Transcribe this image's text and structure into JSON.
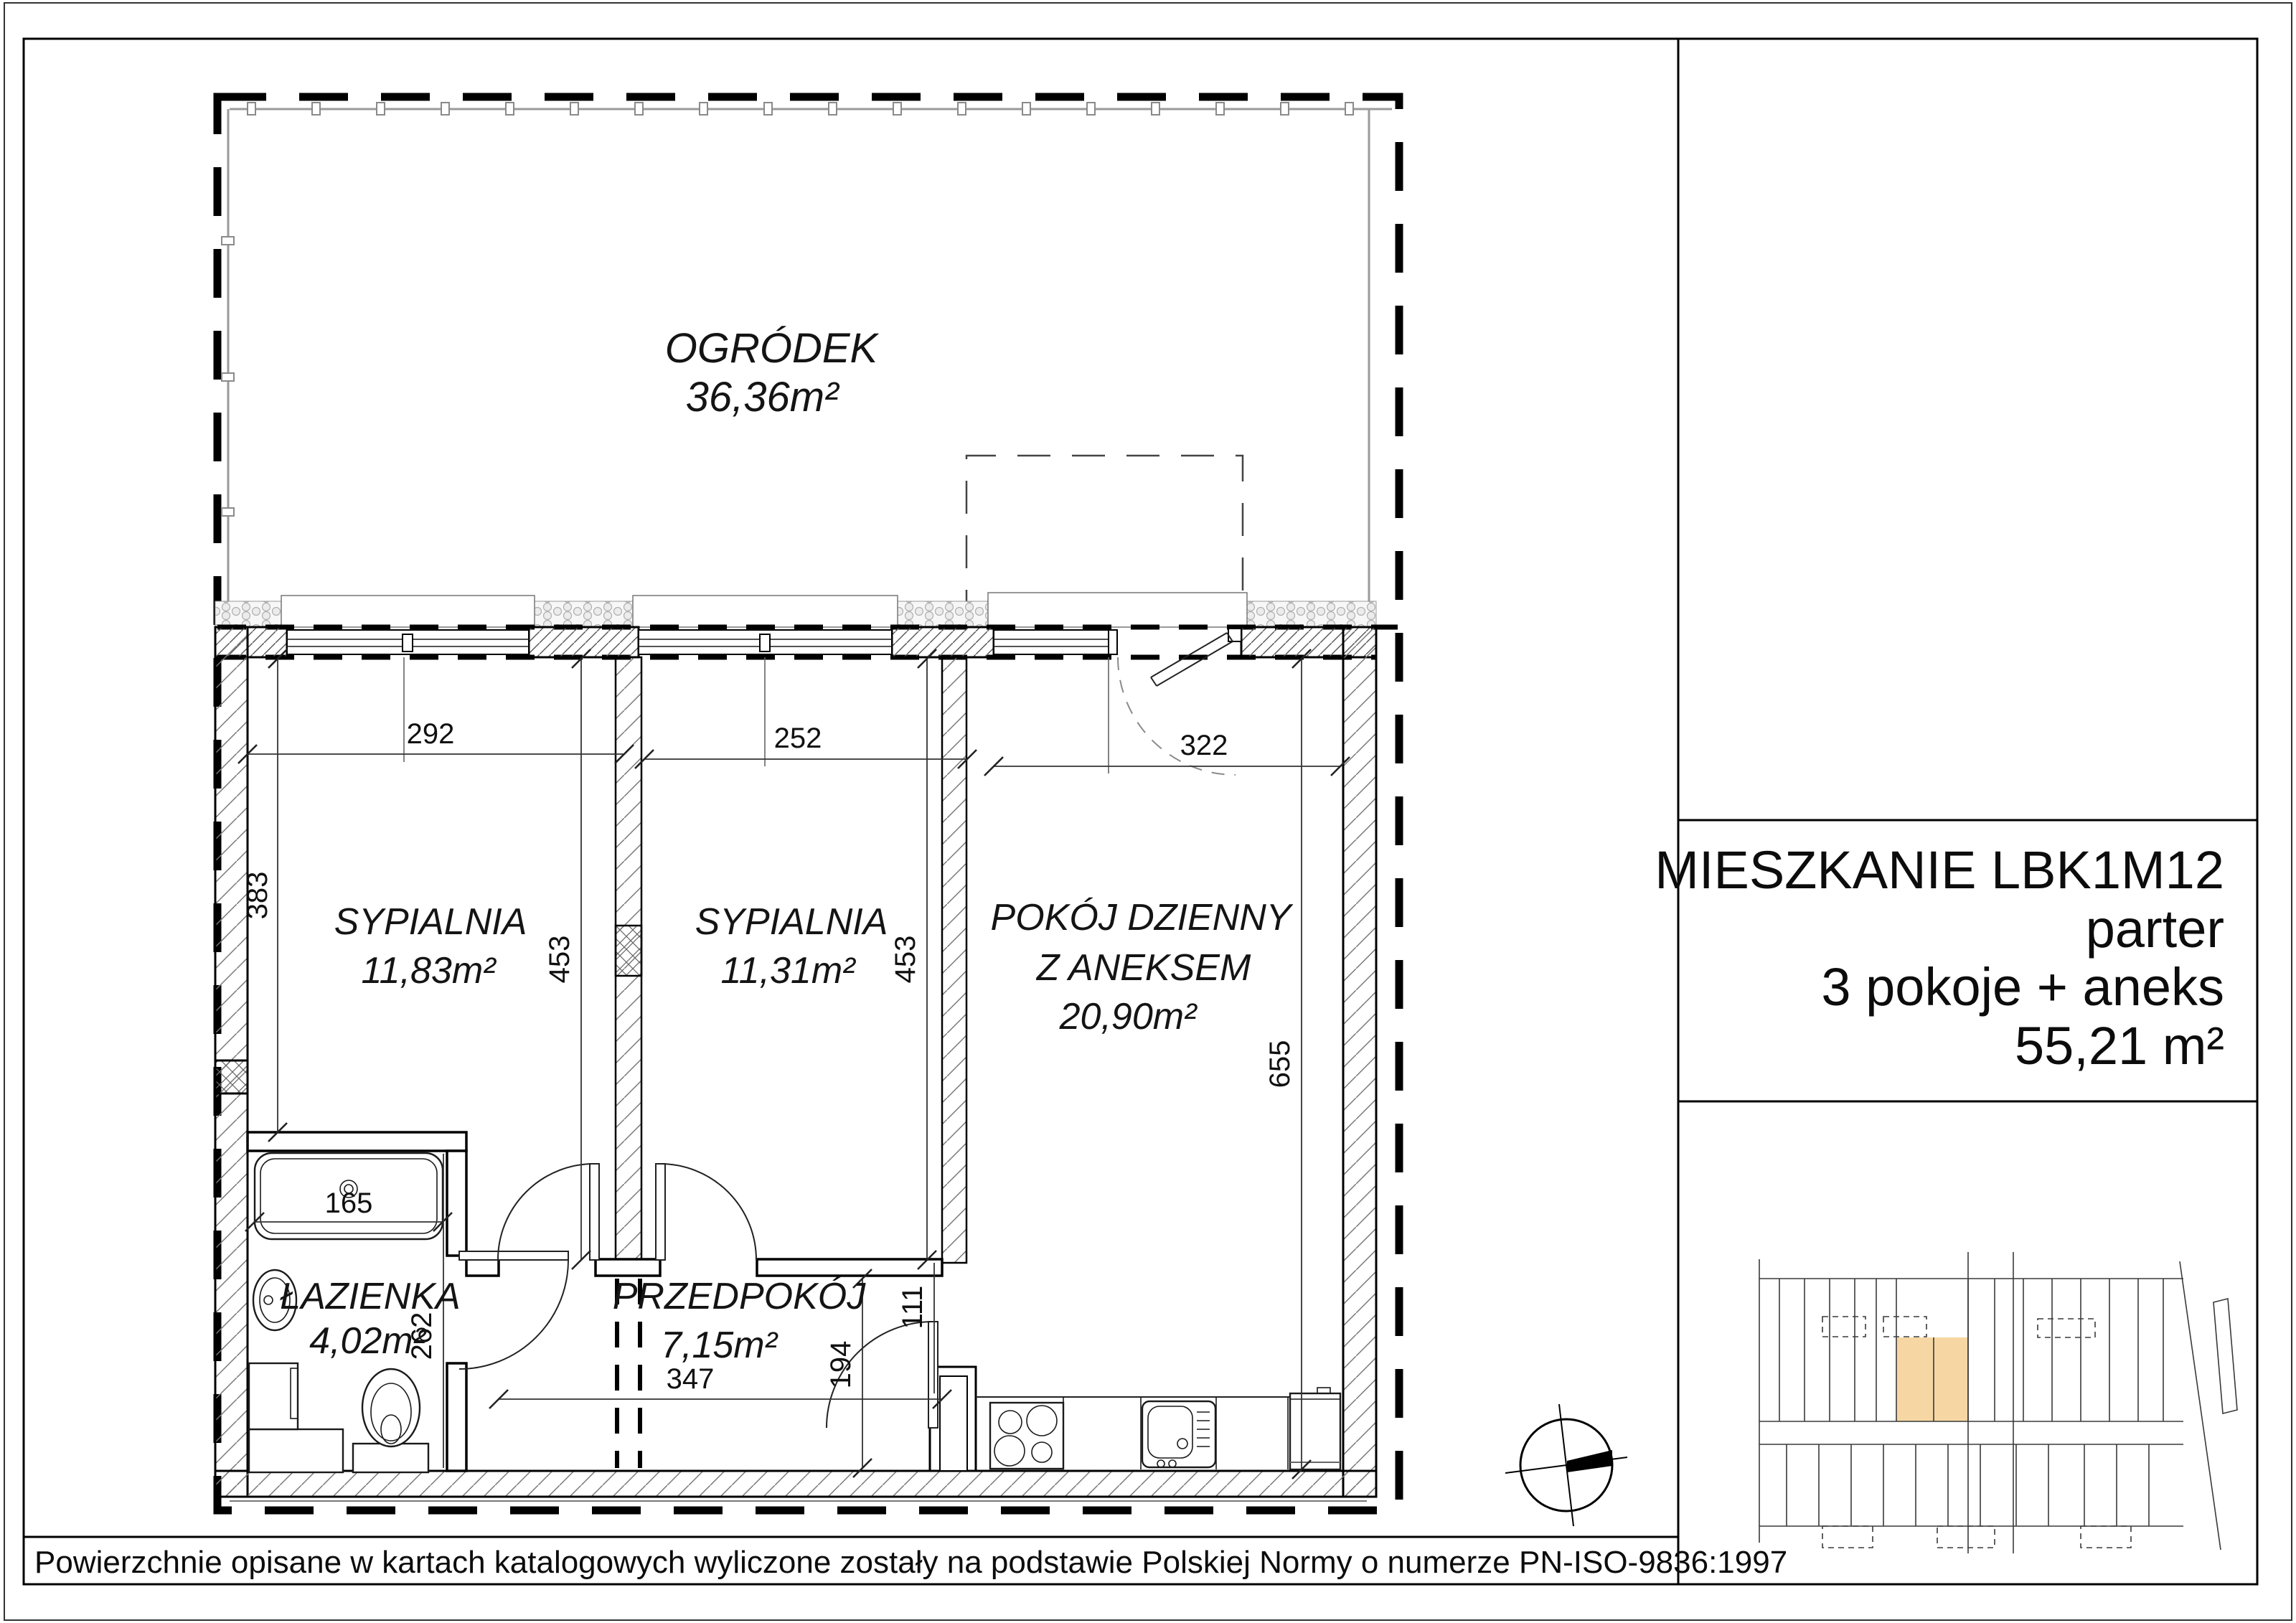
{
  "title_block": {
    "apartment": "MIESZKANIE LBK1M12",
    "floor": "parter",
    "layout": "3 pokoje + aneks",
    "total_area": "55,21 m²"
  },
  "rooms": {
    "garden": {
      "name": "OGRÓDEK",
      "area": "36,36m²"
    },
    "bedroom1": {
      "name": "SYPIALNIA",
      "area": "11,83m²"
    },
    "bedroom2": {
      "name": "SYPIALNIA",
      "area": "11,31m²"
    },
    "living": {
      "name_line1": "POKÓJ  DZIENNY",
      "name_line2": "Z  ANEKSEM",
      "area": "20,90m²"
    },
    "bathroom": {
      "name": "ŁAZIENKA",
      "area": "4,02m²"
    },
    "hallway": {
      "name": "PRZEDPOKÓJ",
      "area": "7,15m²"
    }
  },
  "dimensions_cm": {
    "bedroom1_width": "292",
    "bedroom2_width": "252",
    "living_width": "322",
    "bedroom1_left_depth": "383",
    "bedroom1_depth": "453",
    "bedroom2_depth": "453",
    "living_depth": "655",
    "bathtub_length": "165",
    "bathroom_depth": "262",
    "hallway_width": "347",
    "hallway_door_depth": "194",
    "living_wall_segment": "111"
  },
  "footer": {
    "note": "Powierzchnie opisane w kartach katalogowych wyliczone zostały na podstawie  Polskiej Normy o numerze PN-ISO-9836:1997"
  },
  "colors": {
    "highlight": "#F6D7A4",
    "paper": "#ffffff",
    "line": "#000000"
  }
}
